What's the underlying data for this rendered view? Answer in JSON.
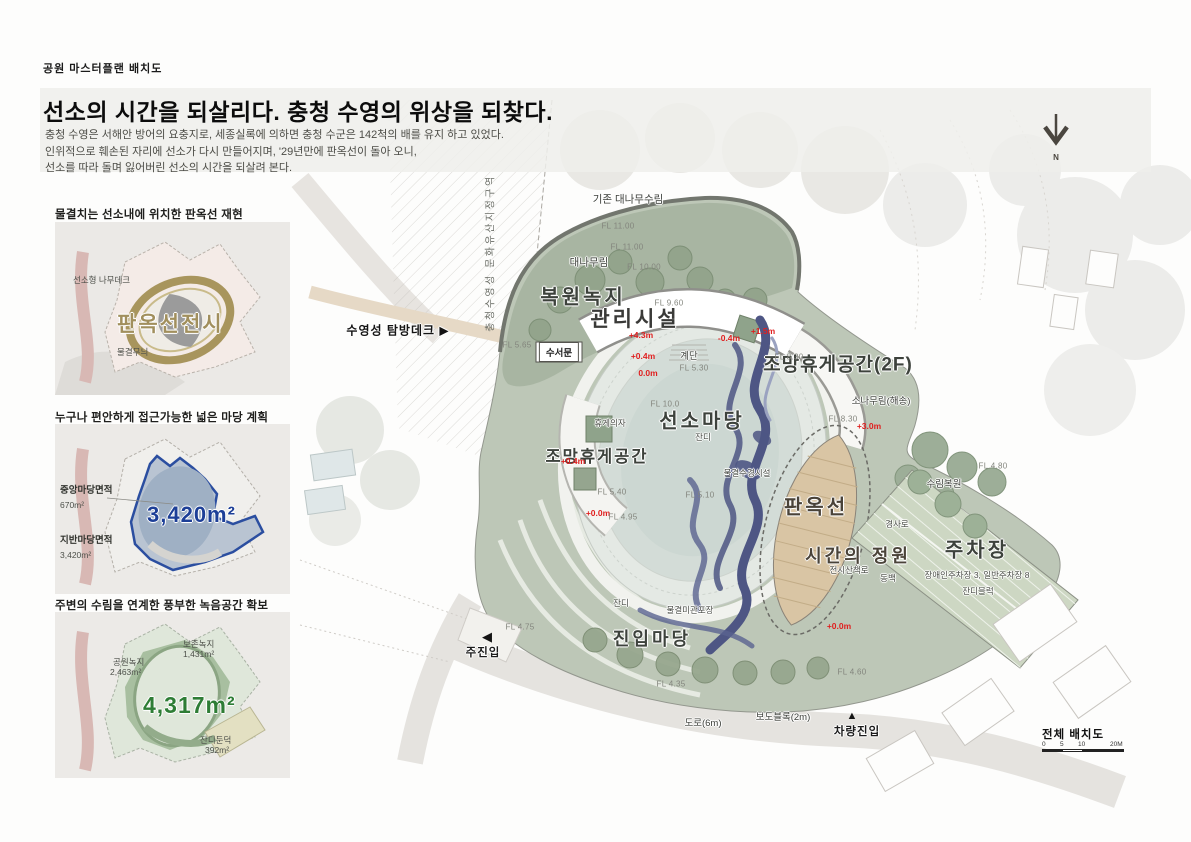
{
  "page": {
    "eyebrow": "공원 마스터플랜 배치도",
    "title": "선소의 시간을 되살리다. 충청 수영의 위상을 되찾다.",
    "intro_lines": [
      "충청 수영은 서해안 방어의 요충지로, 세종실록에 의하면 충청 수군은 142척의 배를 유지 하고 있었다.",
      "인위적으로 훼손된 자리에 선소가 다시 만들어지며, '29년만에 판옥선이 돌아 오니,",
      "선소를 따라 돌며 잃어버린 선소의 시간을 되살려 본다."
    ]
  },
  "panels": [
    {
      "caption": "물결치는 선소내에 위치한 판옥선 재현",
      "labels": {
        "deck": "선소형 나무데크",
        "main": "판옥선전시",
        "wave": "물결무늬"
      }
    },
    {
      "caption": "누구나 편안하게 접근가능한 넓은 마당 계획",
      "labels": {
        "center_title": "중앙마당면적",
        "center_value": "670m²",
        "ground_title": "지반마당면적",
        "ground_value": "3,420m²",
        "big": "3,420m²"
      }
    },
    {
      "caption": "주변의 수림을 연계한 풍부한 녹음공간 확보",
      "labels": {
        "preserve": "보존녹지",
        "preserve_v": "1,431m²",
        "park": "공원녹지",
        "park_v": "2,463m²",
        "big": "4,317m²",
        "mound": "잔디둔덕",
        "mound_v": "392m²"
      }
    }
  ],
  "plan": {
    "labels": {
      "heritage_vertical": "충청수영성 문화유산지정구역",
      "bamboo_existing": "기존 대나무수림",
      "fl_11a": "FL 11.00",
      "fl_11b": "FL 11.00",
      "bamboo_forest": "대나무림",
      "fl_10": "FL 10.00",
      "bokwon_nokji": "복원녹지",
      "fl_960": "FL 9.60",
      "gwanri": "관리시설",
      "tambang": "수영성 탐방데크 ▶",
      "fl_565": "FL 5.65",
      "suseomun": "수서문",
      "red_43": "+4.3m",
      "red_m04": "-0.4m",
      "red_04a": "+0.4m",
      "gyedan": "계단",
      "fl_530": "FL 5.30",
      "red_00a": "0.0m",
      "fl_100c": "FL 10.0",
      "jomang2f": "조망휴게공간(2F)",
      "fl_830a": "FL 8.30",
      "red_15": "+1.5m",
      "sonamu": "소나무림(해송)",
      "fl_830b": "FL 8.30",
      "red_30": "+3.0m",
      "hyuge_chair": "휴게의자",
      "seonso_madang": "선소마당",
      "jandi_a": "잔디",
      "jomang_left": "조망휴게공간",
      "red_04b": "+0.4m",
      "fl_540": "FL 5.40",
      "red_00b": "+0.0m",
      "fl_495": "FL 4.95",
      "fl_510": "FL 5.10",
      "mulgyeol_sugyeong": "물결수경시설",
      "panokseon": "판옥선",
      "sigan_garden": "시간의 정원",
      "jeonsi_walk": "전시산책로",
      "gyeongsaro": "경사로",
      "dongbaek": "동백",
      "surim_bokwon": "수림복원",
      "fl_480": "FL 4.80",
      "jucha": "주차장",
      "jucha_detail": "장애인주차장 3, 일반주차장 8",
      "jandi_block": "잔디블럭",
      "red_00c": "+0.0m",
      "jandi_b": "잔디",
      "mulgyeol_paving": "물결미관포장",
      "jinip_madang": "진입마당",
      "fl_435": "FL 4.35",
      "road6": "도로(6m)",
      "bodoblock": "보도블록(2m)",
      "tri_up": "▲",
      "vehicle_entry": "차량진입",
      "tri_left": "◀",
      "main_entry": "주진입",
      "fl_475": "FL 4.75",
      "fl_460": "FL 4.60"
    }
  },
  "legend": {
    "title": "전체 배치도",
    "ticks": [
      "0",
      "5",
      "10",
      "20M"
    ]
  },
  "north_label": "N",
  "colors": {
    "accent_red": "#e01f1f",
    "big_blue": "#1d3f97",
    "big_green": "#2e7d35",
    "big_tan": "#a18f5d",
    "wave_navy": "#4e5684",
    "site_green": "#bdc7b7",
    "upper_green": "#a8b5a2",
    "boat_tan": "#d9c5a4"
  }
}
